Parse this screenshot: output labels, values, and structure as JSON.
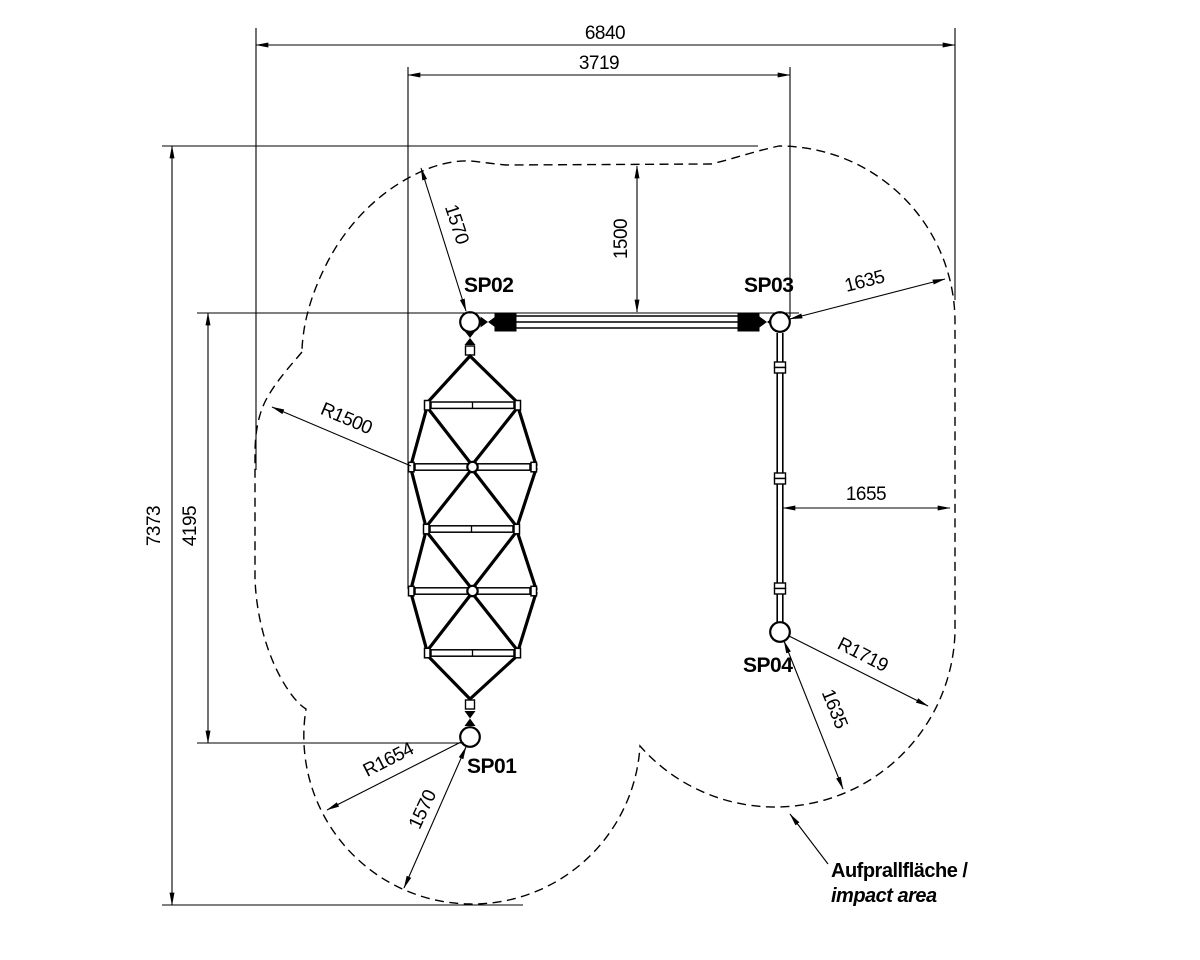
{
  "drawing": {
    "anchors": {
      "sp01": "SP01",
      "sp02": "SP02",
      "sp03": "SP03",
      "sp04": "SP04"
    },
    "dimensions": {
      "total_width": "6840",
      "beam_span": "3719",
      "total_height": "7373",
      "anchor_span": "4195",
      "top_clearance": "1500",
      "sp02_clearance": "1570",
      "net_radius": "R1500",
      "sp01_radius": "R1654",
      "sp01_clearance": "1570",
      "sp03_clearance": "1635",
      "side_clearance": "1655",
      "sp04_radius": "R1719",
      "sp04_clearance": "1635"
    },
    "notes": {
      "impact_line1": "Aufprallfläche /",
      "impact_line2": "impact area"
    },
    "colors": {
      "ink": "#000000",
      "paper": "#ffffff"
    }
  }
}
